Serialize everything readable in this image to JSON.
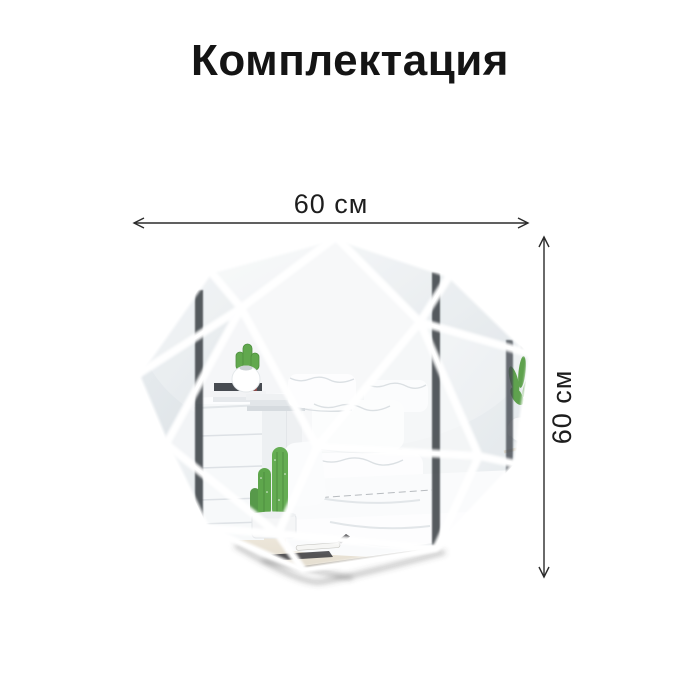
{
  "title": "Комплектация",
  "dimensions": {
    "width_label": "60 см",
    "height_label": "60 см"
  },
  "illustration": {
    "name": "faceted-octagon-mirror",
    "description": "octagonal wall mirror assembled from triangular mirror tiles reflecting a bedroom with nightstand, cacti and white bedding"
  },
  "colors": {
    "background": "#ffffff",
    "title_text": "#141414",
    "dimension_lines": "#2b2b2b",
    "mirror_light": "#f5f7f8",
    "mirror_mid": "#ecf0f2",
    "mirror_dark": "#e2e7ea",
    "seam_white": "#ffffff",
    "wardrobe_stripe": "#3f444a",
    "cactus_green": "#5fa24c",
    "floor_beige": "#ebe5d8"
  }
}
